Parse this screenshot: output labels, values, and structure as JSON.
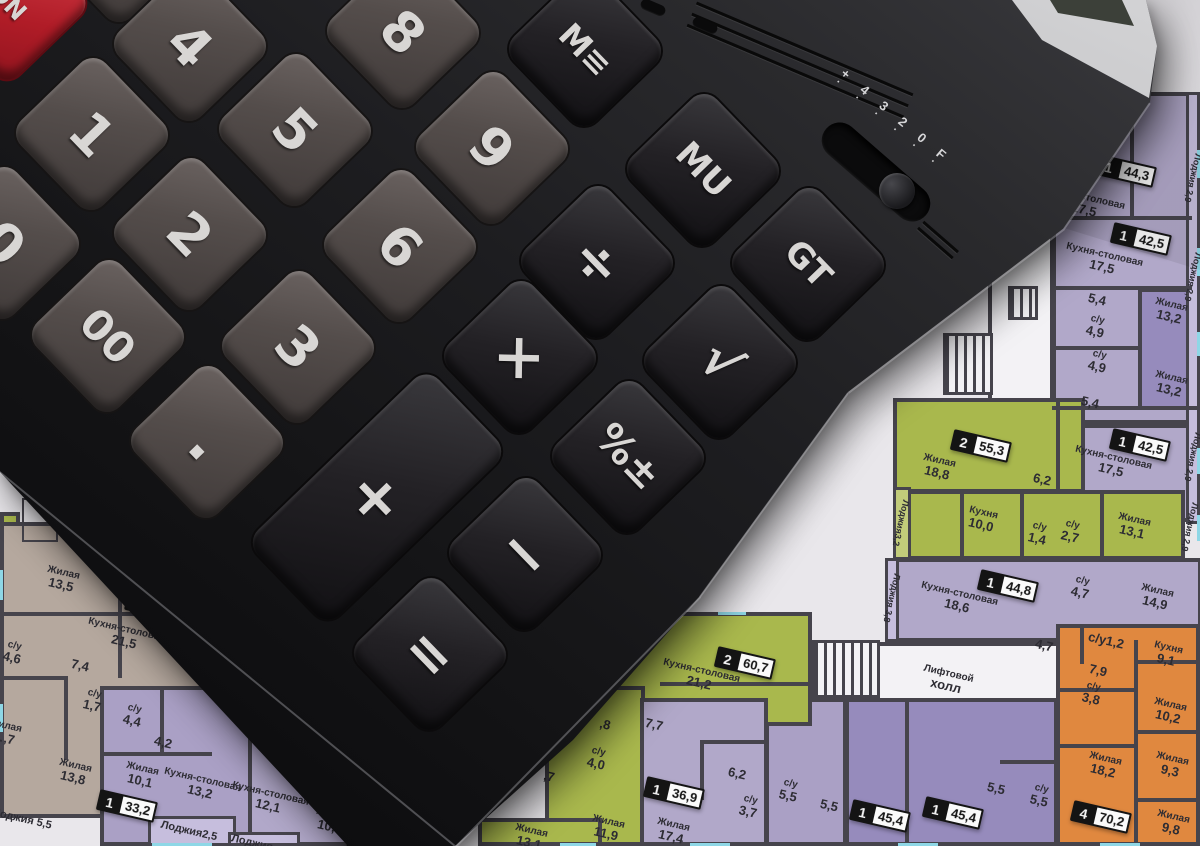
{
  "calculator": {
    "keys": [
      {
        "id": "on",
        "label": "ON"
      },
      {
        "id": "k7",
        "label": "7"
      },
      {
        "id": "k4",
        "label": "4"
      },
      {
        "id": "k8",
        "label": "8"
      },
      {
        "id": "kmem",
        "label": "M≡"
      },
      {
        "id": "k1",
        "label": "1"
      },
      {
        "id": "k5",
        "label": "5"
      },
      {
        "id": "k9",
        "label": "9"
      },
      {
        "id": "kmu",
        "label": "MU"
      },
      {
        "id": "k0",
        "label": "0"
      },
      {
        "id": "k2",
        "label": "2"
      },
      {
        "id": "k6",
        "label": "6"
      },
      {
        "id": "kdiv",
        "label": "÷"
      },
      {
        "id": "kgt",
        "label": "GT"
      },
      {
        "id": "k00",
        "label": "00"
      },
      {
        "id": "k3",
        "label": "3"
      },
      {
        "id": "kmul",
        "label": "×"
      },
      {
        "id": "ksqrt",
        "label": "√"
      },
      {
        "id": "kdot",
        "label": "."
      },
      {
        "id": "kpct",
        "label": "%±"
      },
      {
        "id": "kplus",
        "label": "+"
      },
      {
        "id": "kminus",
        "label": "−"
      },
      {
        "id": "keq",
        "label": "="
      }
    ],
    "mode_slider": {
      "scale": "+ 4 3 2 0 F",
      "dots": "· · · · · ·"
    }
  },
  "floor_plan": {
    "badges": [
      {
        "id": "b1",
        "unit": "1",
        "area": "44,3"
      },
      {
        "id": "b2",
        "unit": "1",
        "area": "42,5"
      },
      {
        "id": "b3",
        "unit": "1",
        "area": "42,5"
      },
      {
        "id": "b4",
        "unit": "2",
        "area": "55,3"
      },
      {
        "id": "b5",
        "unit": "1",
        "area": "44,8"
      },
      {
        "id": "b6",
        "unit": "4",
        "area": "70,2"
      },
      {
        "id": "b7",
        "unit": "1",
        "area": "45,4"
      },
      {
        "id": "b8",
        "unit": "1",
        "area": "45,4"
      },
      {
        "id": "b9",
        "unit": "1",
        "area": "36,9"
      },
      {
        "id": "b10",
        "unit": "2",
        "area": "60,7"
      },
      {
        "id": "b11",
        "unit": "3",
        "area": ""
      },
      {
        "id": "b12",
        "unit": "1",
        "area": "33,2"
      },
      {
        "id": "b13",
        "unit": "1",
        "area": "3"
      }
    ],
    "rooms": [
      {
        "id": "ks1",
        "n": "Кухня-столовая",
        "v": "17,5"
      },
      {
        "id": "ks2",
        "n": "Кухня-столовая",
        "v": "17,5"
      },
      {
        "id": "n54a",
        "n": "",
        "v": "5,4"
      },
      {
        "id": "su49a",
        "n": "с/у",
        "v": "4,9"
      },
      {
        "id": "zh132a",
        "n": "Жилая",
        "v": "13,2"
      },
      {
        "id": "su49b",
        "n": "с/у",
        "v": "4,9"
      },
      {
        "id": "zh132b",
        "n": "Жилая",
        "v": "13,2"
      },
      {
        "id": "n54b",
        "n": "",
        "v": "5,4"
      },
      {
        "id": "ks3",
        "n": "Кухня-столовая",
        "v": "17,5"
      },
      {
        "id": "zh188",
        "n": "Жилая",
        "v": "18,8"
      },
      {
        "id": "n62g",
        "n": "",
        "v": "6,2"
      },
      {
        "id": "kh100",
        "n": "Кухня",
        "v": "10,0"
      },
      {
        "id": "su14",
        "n": "с/у",
        "v": "1,4"
      },
      {
        "id": "su27",
        "n": "с/у",
        "v": "2,7"
      },
      {
        "id": "zh131",
        "n": "Жилая",
        "v": "13,1"
      },
      {
        "id": "ks186",
        "n": "Кухня-столовая",
        "v": "18,6"
      },
      {
        "id": "su47",
        "n": "с/у",
        "v": "4,7"
      },
      {
        "id": "zh149",
        "n": "Жилая",
        "v": "14,9"
      },
      {
        "id": "n47",
        "n": "",
        "v": "4,7"
      },
      {
        "id": "lift1",
        "n": "Лифтовой",
        "v": "холл"
      },
      {
        "id": "lift2",
        "n": "Лифтовой",
        "v": "холл"
      },
      {
        "id": "su12",
        "n": "",
        "v": "с/у1,2"
      },
      {
        "id": "kh91",
        "n": "Кухня",
        "v": "9,1"
      },
      {
        "id": "n79",
        "n": "",
        "v": "7,9"
      },
      {
        "id": "su38",
        "n": "с/у",
        "v": "3,8"
      },
      {
        "id": "zh102",
        "n": "Жилая",
        "v": "10,2"
      },
      {
        "id": "zh182",
        "n": "Жилая",
        "v": "18,2"
      },
      {
        "id": "zh93",
        "n": "Жилая",
        "v": "9,3"
      },
      {
        "id": "zh98",
        "n": "Жилая",
        "v": "9,8"
      },
      {
        "id": "su55a",
        "n": "с/у",
        "v": "5,5"
      },
      {
        "id": "n55a",
        "n": "",
        "v": "5,5"
      },
      {
        "id": "n55b",
        "n": "",
        "v": "5,5"
      },
      {
        "id": "su55b",
        "n": "с/у",
        "v": "5,5"
      },
      {
        "id": "n62p",
        "n": "",
        "v": "6,2"
      },
      {
        "id": "su37",
        "n": "с/у",
        "v": "3,7"
      },
      {
        "id": "zh174",
        "n": "Жилая",
        "v": "17,4"
      },
      {
        "id": "ks212",
        "n": "Кухня-столовая",
        "v": "21,2"
      },
      {
        "id": "n77",
        "n": "",
        "v": "7,7"
      },
      {
        "id": "su40g",
        "n": "с/у",
        "v": "4,0"
      },
      {
        "id": "zh119",
        "n": "Жилая",
        "v": "11,9"
      },
      {
        "id": "p8",
        "n": "",
        "v": ",8"
      },
      {
        "id": "p7",
        "n": "",
        "v": ",7"
      },
      {
        "id": "zh13x",
        "n": "Жилая",
        "v": "13,1"
      },
      {
        "id": "zh135",
        "n": "Жилая",
        "v": "13,5"
      },
      {
        "id": "ks215",
        "n": "Кухня-столовая",
        "v": "21,5"
      },
      {
        "id": "su46",
        "n": "с/у",
        "v": "4,6"
      },
      {
        "id": "n74",
        "n": "",
        "v": "7,4"
      },
      {
        "id": "su17",
        "n": "с/у",
        "v": "1,7"
      },
      {
        "id": "zhx7",
        "n": "Жилая",
        "v": "…,7"
      },
      {
        "id": "zh138",
        "n": "Жилая",
        "v": "13,8"
      },
      {
        "id": "su44",
        "n": "с/у",
        "v": "4,4"
      },
      {
        "id": "n42",
        "n": "",
        "v": "4,2"
      },
      {
        "id": "zh101",
        "n": "Жилая",
        "v": "10,1"
      },
      {
        "id": "ks132",
        "n": "Кухня-столовая",
        "v": "13,2"
      },
      {
        "id": "ks121",
        "n": "Кухня-столовая",
        "v": "12,1"
      },
      {
        "id": "n39",
        "n": "",
        "v": "3,9"
      },
      {
        "id": "su40t",
        "n": "с/у",
        "v": "4,0"
      },
      {
        "id": "zh104",
        "n": "Жилая",
        "v": "10,4"
      }
    ],
    "loggias": [
      {
        "id": "lg29t",
        "text": "Лоджия 2,9"
      },
      {
        "id": "lg29a",
        "text": "Лоджия 2,9"
      },
      {
        "id": "lg29b",
        "text": "Лоджия 2,9"
      },
      {
        "id": "lg29c",
        "text": "Лоджия 2,9"
      },
      {
        "id": "lg32",
        "text": "Лоджия3,2"
      },
      {
        "id": "lg38",
        "text": "Лоджия 3,8"
      },
      {
        "id": "lg55",
        "text": "Лоджия  5,5"
      },
      {
        "id": "lg25",
        "text": "Лоджия2,5"
      },
      {
        "id": "lgx",
        "text": "Лоджия"
      }
    ]
  },
  "colors": {
    "paper": "#e9e7eb",
    "wall": "#46444c",
    "window": "#8ed7e6",
    "purple_light": "#b1a8c9",
    "purple_mid": "#968bbc",
    "green": "#a9b84d",
    "orange": "#e0883f",
    "tan": "#b5a89e",
    "key_red": "#c2202c",
    "body_black": "#151517"
  }
}
